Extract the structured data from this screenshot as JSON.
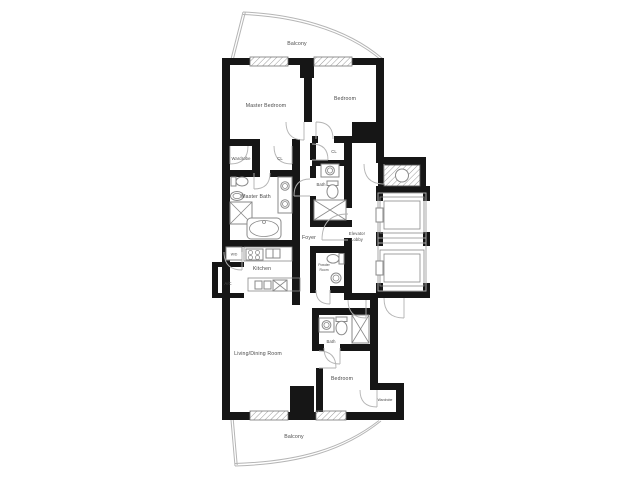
{
  "plan": {
    "labels": {
      "balcony_top": "Balcony",
      "master_bedroom": "Master Bedroom",
      "bedroom_top": "Bedroom",
      "wardrobe_master": "Wardrobe",
      "closet_master": "CL",
      "closet_bedroom": "CL",
      "master_bath": "Master Bath",
      "bath_mid": "Bath",
      "foyer": "Foyer",
      "elevator_lobby_line1": "Elevator",
      "elevator_lobby_line2": "Lobby",
      "powder_line1": "Powder",
      "powder_line2": "Room",
      "kitchen": "Kitchen",
      "ac_closet": "A/C",
      "washer_dryer": "W/D",
      "living_dining": "Living/Dining Room",
      "bath_lower": "Bath",
      "bedroom_lower": "Bedroom",
      "wardrobe_lower": "Wardrobe",
      "balcony_bottom": "Balcony"
    },
    "colors": {
      "wall": "#161616",
      "fixture_line": "#8a8a8a",
      "label_text": "#4a4a4a",
      "background": "#ffffff"
    }
  }
}
